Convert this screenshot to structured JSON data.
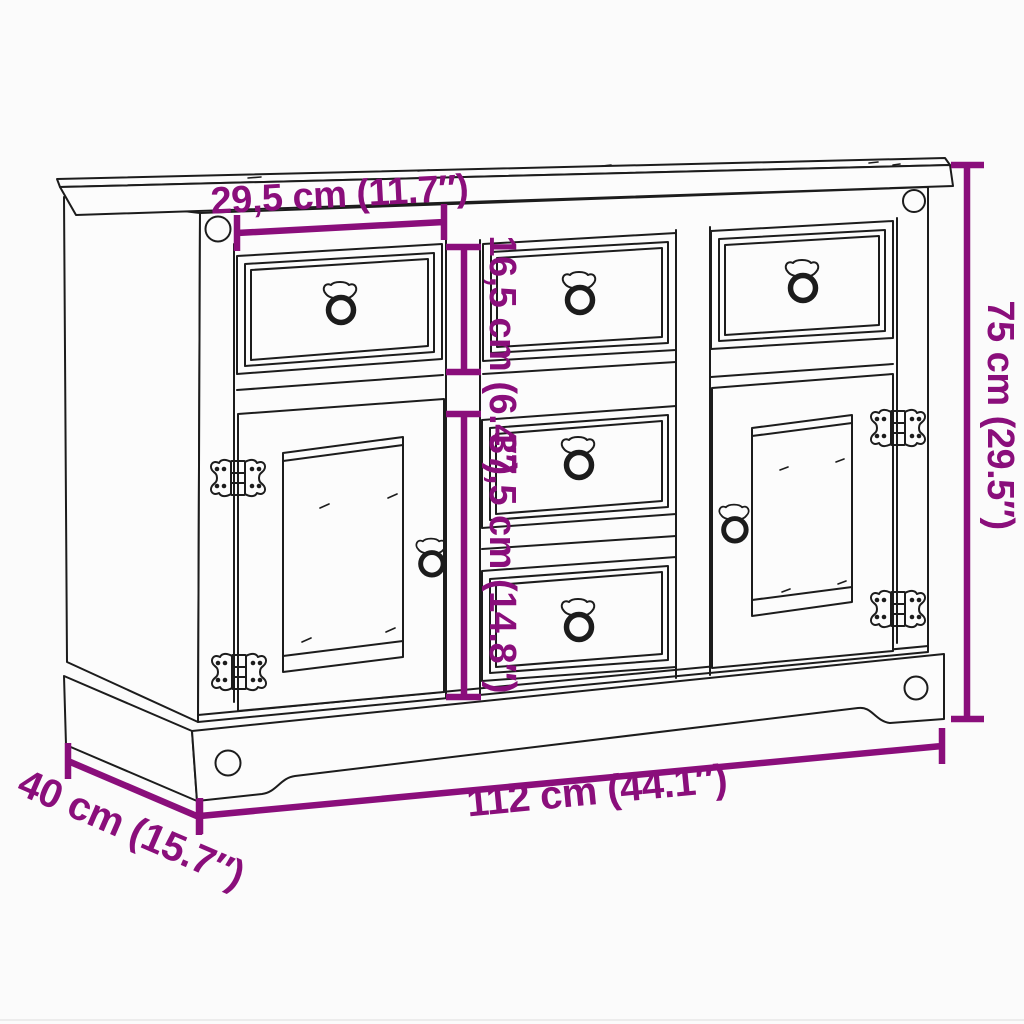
{
  "colors": {
    "background": "#FBFBFB",
    "line_art": "#1C1C1C",
    "dimension_annotation": "#8A0E7B"
  },
  "dimensions": {
    "drawer_width": "29,5 cm (11.7″)",
    "top_drawer_height": "16,5 cm (6.4″)",
    "middle_drawers_height": "37,5 cm (14.8″)",
    "total_height": "75 cm (29.5″)",
    "total_width": "112 cm (44.1″)",
    "depth": "40 cm (15.7″)"
  }
}
